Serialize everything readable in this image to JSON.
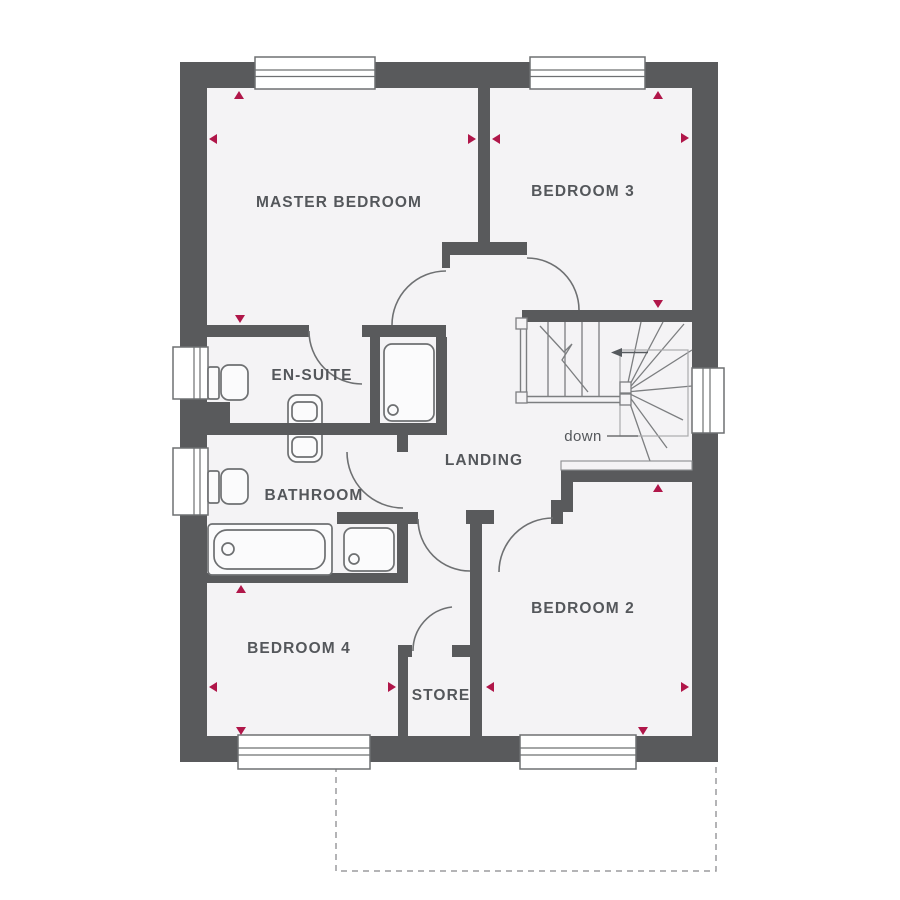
{
  "plan": {
    "type": "floor-plan",
    "rooms": [
      {
        "id": "master-bedroom",
        "label": "MASTER BEDROOM"
      },
      {
        "id": "bedroom-3",
        "label": "BEDROOM 3"
      },
      {
        "id": "en-suite",
        "label": "EN-SUITE"
      },
      {
        "id": "bathroom",
        "label": "BATHROOM"
      },
      {
        "id": "landing",
        "label": "LANDING"
      },
      {
        "id": "bedroom-4",
        "label": "BEDROOM 4"
      },
      {
        "id": "store",
        "label": "STORE"
      },
      {
        "id": "bedroom-2",
        "label": "BEDROOM 2"
      }
    ],
    "stairs": {
      "down_label": "down"
    },
    "fixtures": [
      "toilet",
      "toilet",
      "basin",
      "shower",
      "shower",
      "bath",
      "winder-staircase"
    ],
    "windows_count": 7,
    "dimension_markers_count": 16,
    "colors": {
      "wall": "#595a5c",
      "floor": "#f4f3f5",
      "fixture_line": "#6e7072",
      "dimension_marker": "#b01649",
      "label_text": "#54575b",
      "footprint_dash": "#9b9b9d"
    }
  }
}
